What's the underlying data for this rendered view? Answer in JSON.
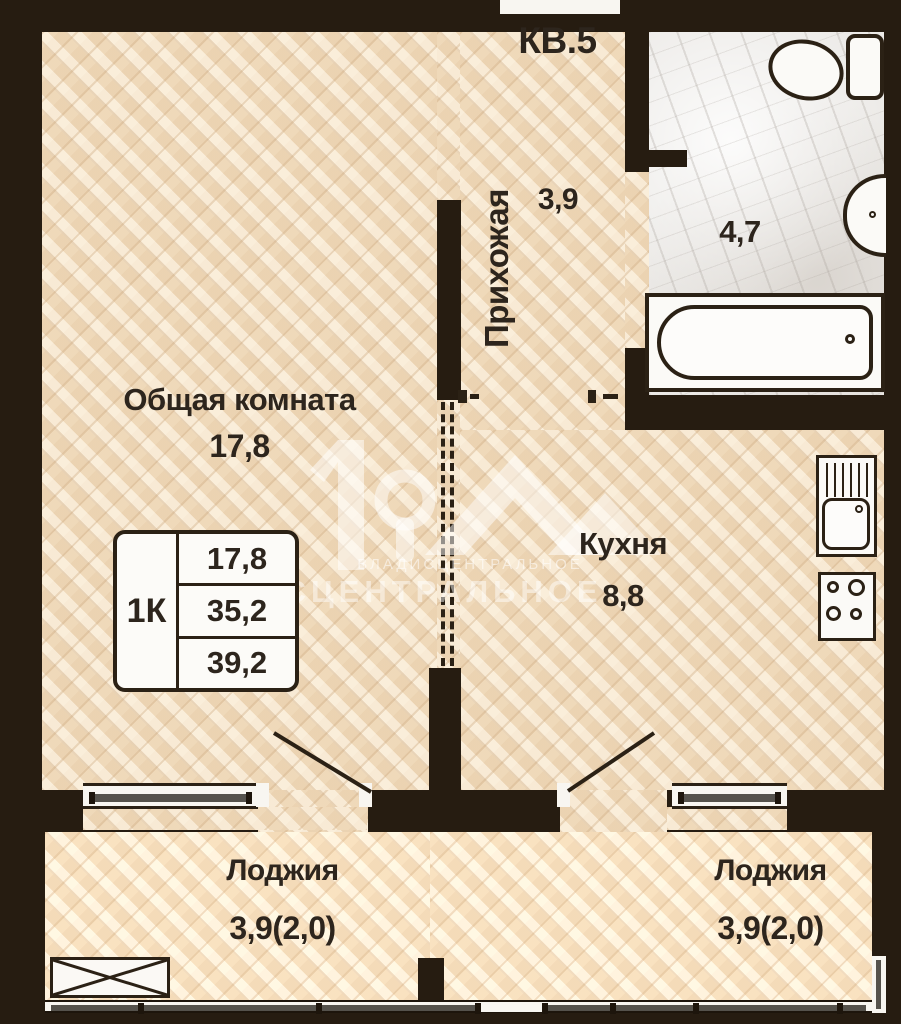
{
  "title": "КВ.5",
  "colors": {
    "wall": "#261c11",
    "wood_floor": "#f3e0c5",
    "marble_floor": "#eceae7",
    "label_text": "#2d251d",
    "window_glass": "#55524c",
    "fixture_fill": "#fbfaf7"
  },
  "rooms": {
    "living": {
      "name": "Общая комната",
      "area": "17,8"
    },
    "hallway": {
      "name": "Прихожая",
      "area": "3,9"
    },
    "bathroom": {
      "area": "4,7"
    },
    "kitchen": {
      "name": "Кухня",
      "area": "8,8"
    },
    "loggia_left": {
      "name": "Лоджия",
      "area": "3,9(2,0)"
    },
    "loggia_right": {
      "name": "Лоджия",
      "area": "3,9(2,0)"
    }
  },
  "info_table": {
    "unit": "1К",
    "rows": [
      "17,8",
      "35,2",
      "39,2"
    ]
  },
  "watermark": {
    "line_small": "ВЛАДИСЦЕНТРАЛЬНОЕ",
    "line_large": "ВЛАДИСЦЕНТРАЛЬНОЕ"
  }
}
